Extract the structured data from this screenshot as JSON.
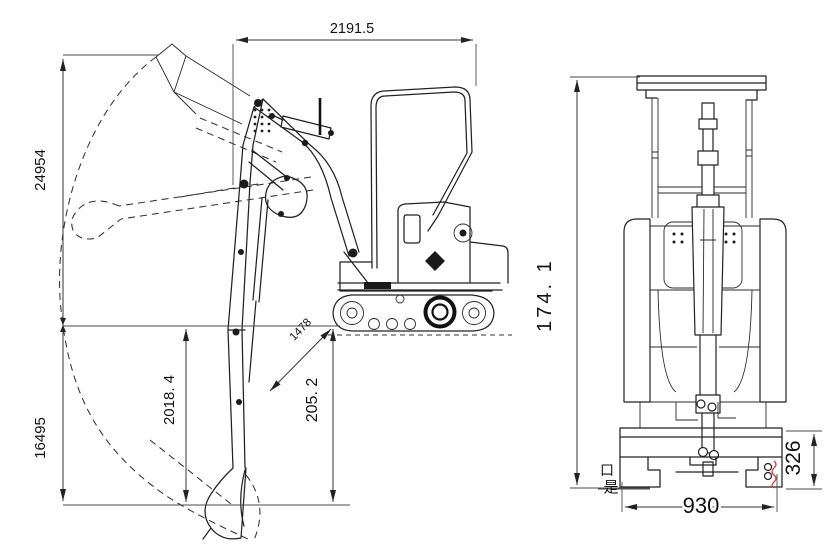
{
  "drawing": {
    "type": "technical-dimension-drawing",
    "subject": "mini excavator, side view with working envelope and front view"
  },
  "side_view": {
    "dimensions": {
      "top_width": "2191.5",
      "max_height": "24954",
      "lower_height": "16495",
      "dig_depth": "2018. 4",
      "front_depth": "205. 2",
      "diagonal": "1478"
    }
  },
  "front_view": {
    "dimensions": {
      "overall_height": "174. 1",
      "track_height": "326",
      "track_width": "930"
    },
    "annotations": {
      "cjk_top": "口",
      "cjk_bottom": "是"
    }
  },
  "colors": {
    "line": "#222222",
    "dimension_line": "#333333",
    "red_mark": "#cc3333",
    "background": "#ffffff"
  }
}
